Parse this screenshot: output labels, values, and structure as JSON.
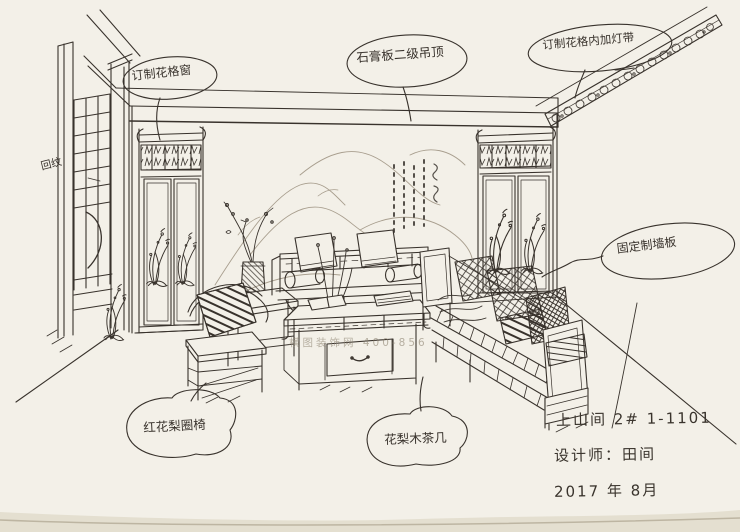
{
  "annotations": {
    "lattice_window": {
      "label": "订制花格窗"
    },
    "ceiling": {
      "label": "石膏板二级吊顶"
    },
    "cornice_light": {
      "label": "订制花格内加灯带"
    },
    "wall_panel": {
      "label": "固定制墙板"
    },
    "armchair": {
      "label": "红花梨圈椅"
    },
    "tea_table": {
      "label": "花梨木茶几"
    },
    "fret_note": {
      "label": "回纹"
    }
  },
  "title_block": {
    "project": "上山间 2#  1-1101",
    "designer": "设计师：田间",
    "date": "2017 年 8月"
  },
  "watermark": "横图装饰网 400-856",
  "colors": {
    "paper": "#f3f0e8",
    "ink": "#38322c",
    "mural": "#a89e8e"
  }
}
